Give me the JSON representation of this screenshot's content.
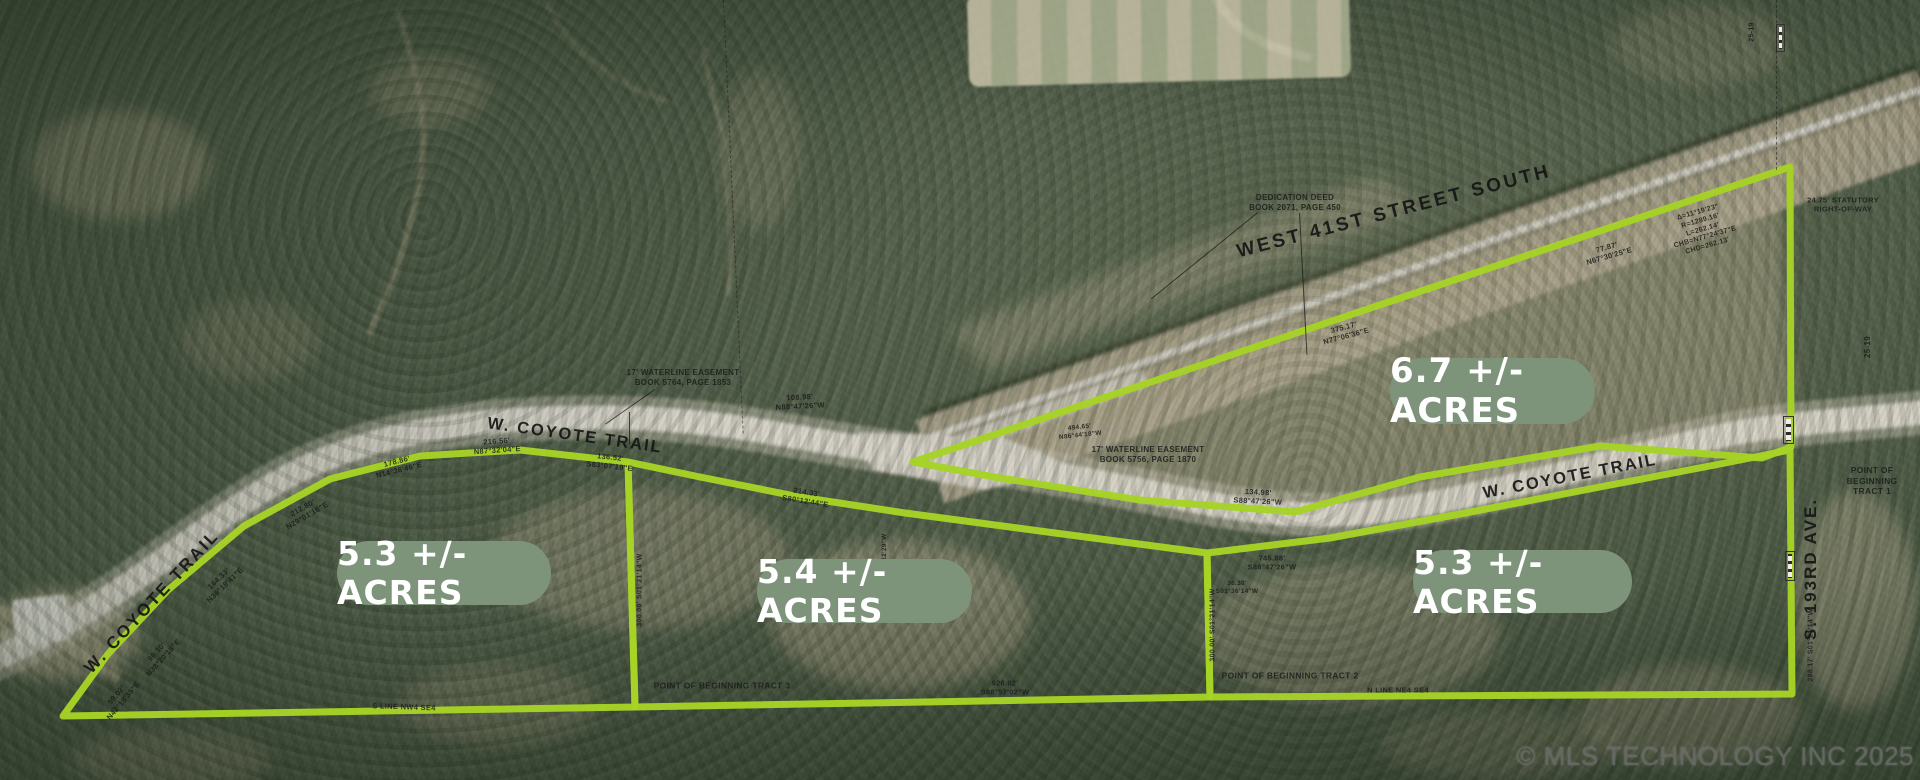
{
  "map": {
    "watermark": "© MLS TECHNOLOGY INC 2025",
    "colors": {
      "boundary": "#a6d326",
      "badge_bg": "#7d947b",
      "badge_text": "#ffffff",
      "label_color": "#161616"
    },
    "badges": [
      {
        "id": "tract-west",
        "label": "5.3 +/- ACRES"
      },
      {
        "id": "tract-middle",
        "label": "5.4 +/- ACRES"
      },
      {
        "id": "tract-northeast",
        "label": "6.7 +/- ACRES"
      },
      {
        "id": "tract-east",
        "label": "5.3 +/- ACRES"
      }
    ],
    "road_labels": {
      "coyote_left": "W. COYOTE TRAIL",
      "coyote_mid": "W. COYOTE TRAIL",
      "coyote_right": "W. COYOTE TRAIL",
      "west_41st": "WEST 41ST STREET SOUTH",
      "s_193rd": "S. 193RD AVE."
    },
    "parcels": [
      {
        "id": "west-5_3",
        "acres": "5.3",
        "points": "63,716 108,654 168,590 244,526 330,479 420,456 520,450 628,462 635,707"
      },
      {
        "id": "middle-5_4",
        "acres": "5.4",
        "points": "628,462 700,477 800,497 905,513 1055,533 1207,553 1210,697 635,707"
      },
      {
        "id": "east-5_3",
        "acres": "5.3",
        "points": "1207,553 1330,538 1460,514 1600,487 1720,464 1790,450 1792,694 1210,697"
      },
      {
        "id": "northeast-6_7",
        "acres": "6.7",
        "points": "913,462 1790,167 1791,447 1762,458 1600,446 1420,477 1295,512 1140,500 1000,478"
      }
    ],
    "annotations": [
      {
        "x": 120,
        "y": 698,
        "rot": -50,
        "text": "59.02'\nN42°18'35\"E"
      },
      {
        "x": 160,
        "y": 655,
        "rot": -48,
        "text": "98.30'\nN38°20'18\"E"
      },
      {
        "x": 222,
        "y": 582,
        "rot": -44,
        "text": "164.33'\nN36°18'41\"E"
      },
      {
        "x": 305,
        "y": 512,
        "rot": -30,
        "text": "212.80'\nN29°01'18\"E"
      },
      {
        "x": 398,
        "y": 466,
        "rot": -14,
        "text": "178.86'\nN14°36'46\"E"
      },
      {
        "x": 497,
        "y": 446,
        "rot": -4,
        "text": "216.56'\nN87°32'04\"E"
      },
      {
        "x": 610,
        "y": 462,
        "rot": 6,
        "text": "136.52'\nS83°07'19\"E"
      },
      {
        "x": 806,
        "y": 497,
        "rot": 9,
        "text": "214.33'\nS80°12'44\"E"
      },
      {
        "x": 800,
        "y": 402,
        "rot": -3,
        "text": "108.98'\nN88°47'26\"W"
      },
      {
        "x": 1080,
        "y": 432,
        "rot": -6,
        "size": 6.5,
        "text": "494.65'\nN86°44'18\"W"
      },
      {
        "x": 1345,
        "y": 332,
        "rot": -15,
        "text": "375.17'\nN77°06'36\"E"
      },
      {
        "x": 1148,
        "y": 455,
        "rot": 0,
        "size": 8,
        "text": "17' WATERLINE EASEMENT\nBOOK 5756, PAGE 1870"
      },
      {
        "x": 683,
        "y": 378,
        "rot": 0,
        "size": 8,
        "text": "17' WATERLINE EASEMENT\nBOOK 5764, PAGE 1853"
      },
      {
        "x": 1295,
        "y": 203,
        "rot": 0,
        "size": 8,
        "text": "DEDICATION DEED\nBOOK 2071, PAGE 450"
      },
      {
        "x": 1258,
        "y": 497,
        "rot": 3,
        "text": "134.98'\nS88°47'26\"W"
      },
      {
        "x": 1272,
        "y": 563,
        "rot": 0,
        "text": "745.88'\nS88°47'26\"W"
      },
      {
        "x": 1237,
        "y": 588,
        "rot": 0,
        "size": 6.5,
        "text": "36.38'\nS01°36'14\"W"
      },
      {
        "x": 1703,
        "y": 230,
        "rot": -16,
        "size": 7,
        "text": "Δ=11°19'23\"\nR=1289.16'\nL=262.14'\nCHB=N77°24'37\"E\nCHD=262.13'"
      },
      {
        "x": 1843,
        "y": 205,
        "rot": 0,
        "size": 7.5,
        "text": "24.75' STATUTORY\nRIGHT-OF-WAY"
      },
      {
        "x": 1608,
        "y": 252,
        "rot": -16,
        "text": "77.87'\nN67°30'25\"E"
      },
      {
        "x": 722,
        "y": 686,
        "rot": 0,
        "size": 8.5,
        "text": "POINT OF BEGINNING TRACT 3"
      },
      {
        "x": 1290,
        "y": 676,
        "rot": 0,
        "size": 8.5,
        "text": "POINT OF BEGINNING TRACT 2"
      },
      {
        "x": 1872,
        "y": 481,
        "rot": 0,
        "size": 8.5,
        "text": "POINT OF BEGINNING TRACT 1"
      },
      {
        "x": 404,
        "y": 707,
        "rot": 2,
        "size": 7.5,
        "text": "S LINE NW4 SE4"
      },
      {
        "x": 1398,
        "y": 690,
        "rot": 0,
        "size": 7.5,
        "text": "N LINE NE4 SE4"
      },
      {
        "x": 1005,
        "y": 688,
        "rot": 0,
        "text": "926.02'\nS88°57'02\"W"
      },
      {
        "x": 641,
        "y": 590,
        "rot": -90,
        "size": 7,
        "text": "300.00' S01°21'14\"W"
      },
      {
        "x": 1214,
        "y": 625,
        "rot": -90,
        "size": 7,
        "text": "300.00' S01°21'14\"W"
      },
      {
        "x": 885,
        "y": 555,
        "rot": -90,
        "size": 6.5,
        "text": "N01°12'29\"W"
      },
      {
        "x": 1812,
        "y": 645,
        "rot": -90,
        "size": 7,
        "text": "288.17' S01°21'14\"W"
      },
      {
        "x": 1868,
        "y": 347,
        "rot": -90,
        "size": 8,
        "text": "25-19"
      },
      {
        "x": 1753,
        "y": 32,
        "rot": -90,
        "size": 7,
        "text": "25-19"
      }
    ],
    "markers": [
      {
        "x": 1776,
        "y": 24,
        "w": 9,
        "h": 28
      },
      {
        "x": 1783,
        "y": 416,
        "w": 11,
        "h": 28
      },
      {
        "x": 1785,
        "y": 551,
        "w": 10,
        "h": 30
      }
    ],
    "lines": [
      {
        "x": 1258,
        "y": 213,
        "len": 137,
        "rot": 141,
        "dashed": false
      },
      {
        "x": 1300,
        "y": 213,
        "len": 142,
        "rot": 87,
        "dashed": false
      },
      {
        "x": 655,
        "y": 390,
        "len": 60,
        "rot": 145,
        "dashed": false
      },
      {
        "x": 630,
        "y": 412,
        "len": 32,
        "rot": 90,
        "dashed": false
      },
      {
        "x": 1777,
        "y": 0,
        "len": 170,
        "rot": 90,
        "dashed": true
      },
      {
        "x": 724,
        "y": 0,
        "len": 434,
        "rot": 87.4,
        "dashed": true
      }
    ]
  }
}
